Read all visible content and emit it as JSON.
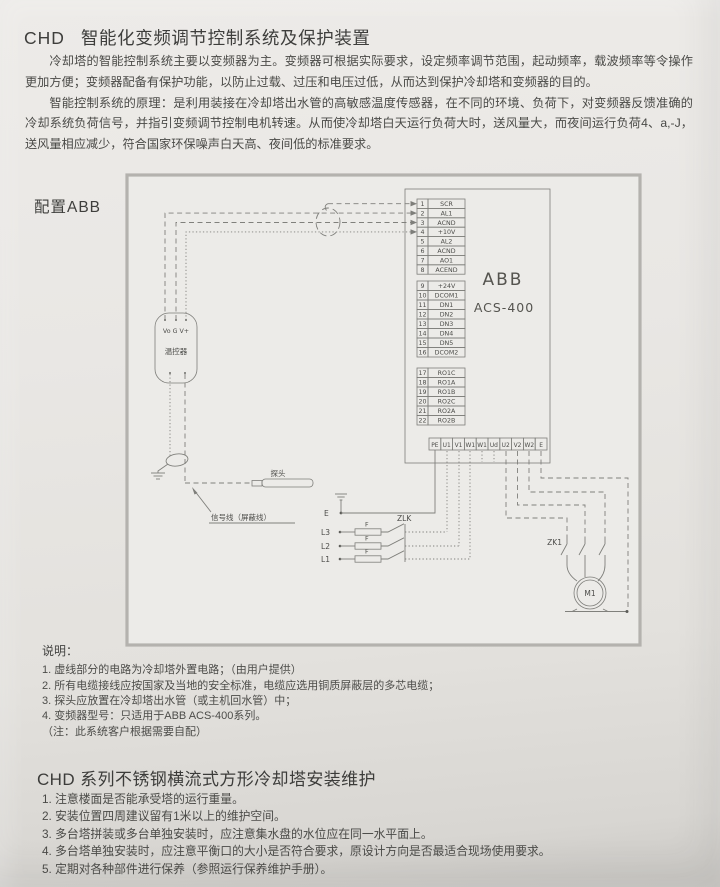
{
  "header": {
    "brand": "CHD",
    "title": "智能化变频调节控制系统及保护装置"
  },
  "intro": {
    "p1": "冷却塔的智能控制系统主要以变频器为主。变频器可根据实际要求，设定频率调节范围，起动频率，载波频率等令操作更加方便；变频器配备有保护功能，以防止过载、过压和电压过低，从而达到保护冷却塔和变频器的目的。",
    "p2": "智能控制系统的原理：是利用装接在冷却塔出水管的高敏感温度传感器，在不同的环境、负荷下，对变频器反馈准确的冷却系统负荷信号，并指引变频调节控制电机转速。从而使冷却塔白天运行负荷大时，送风量大，而夜间运行负荷4、a,-J，送风量相应减少，符合国家环保噪声白天高、夜间低的标准要求。"
  },
  "config_label": "配置ABB",
  "diagram": {
    "device_brand": "ABB",
    "device_model": "ACS-400",
    "groups": [
      {
        "rows": [
          {
            "no": "1",
            "label": "SCR"
          },
          {
            "no": "2",
            "label": "AL1"
          },
          {
            "no": "3",
            "label": "ACND"
          },
          {
            "no": "4",
            "label": "+10V"
          },
          {
            "no": "5",
            "label": "AL2"
          },
          {
            "no": "6",
            "label": "ACND"
          },
          {
            "no": "7",
            "label": "AO1"
          },
          {
            "no": "8",
            "label": "ACEND"
          }
        ]
      },
      {
        "rows": [
          {
            "no": "9",
            "label": "+24V"
          },
          {
            "no": "10",
            "label": "DCOM1"
          },
          {
            "no": "11",
            "label": "DN1"
          },
          {
            "no": "12",
            "label": "DN2"
          },
          {
            "no": "13",
            "label": "DN3"
          },
          {
            "no": "14",
            "label": "DN4"
          },
          {
            "no": "15",
            "label": "DN5"
          },
          {
            "no": "16",
            "label": "DCOM2"
          }
        ]
      },
      {
        "rows": [
          {
            "no": "17",
            "label": "RO1C"
          },
          {
            "no": "18",
            "label": "RO1A"
          },
          {
            "no": "19",
            "label": "RO1B"
          },
          {
            "no": "20",
            "label": "RO2C"
          },
          {
            "no": "21",
            "label": "RO2A"
          },
          {
            "no": "22",
            "label": "RO2B"
          }
        ]
      }
    ],
    "power_terminals": [
      "PE",
      "U1",
      "V1",
      "W1",
      "W1",
      "Ud",
      "U2",
      "V2",
      "W2",
      "E"
    ],
    "controller_pins": "Vo G V+",
    "controller_label": "温控器",
    "probe_label": "探头",
    "signal_label": "信号线（屏蔽线）",
    "earth_label": "E",
    "phase_l3": "L3",
    "phase_l2": "L2",
    "phase_l1": "L1",
    "fuse_label": "F",
    "breaker_label": "ZLK",
    "contactor_label": "ZK1",
    "motor_label": "M1"
  },
  "notes": {
    "heading": "说明：",
    "items": [
      "1. 虚线部分的电路为冷却塔外置电路；（由用户提供）",
      "2. 所有电缆接线应按国家及当地的安全标准，电缆应选用铜质屏蔽层的多芯电缆；",
      "3. 探头应放置在冷却塔出水管（或主机回水管）中；",
      "4. 变频器型号：只适用于ABB ACS-400系列。"
    ],
    "footnote": "（注：此系统客户根据需要自配）"
  },
  "maintenance": {
    "title": "CHD 系列不锈钢横流式方形冷却塔安装维护",
    "items": [
      "1. 注意楼面是否能承受塔的运行重量。",
      "2. 安装位置四周建议留有1米以上的维护空间。",
      "3. 多台塔拼装或多台单独安装时，应注意集水盘的水位应在同一水平面上。",
      "4. 多台塔单独安装时，应注意平衡口的大小是否符合要求，原设计方向是否最适合现场使用要求。",
      "5. 定期对各种部件进行保养（参照运行保养维护手册）。"
    ]
  }
}
